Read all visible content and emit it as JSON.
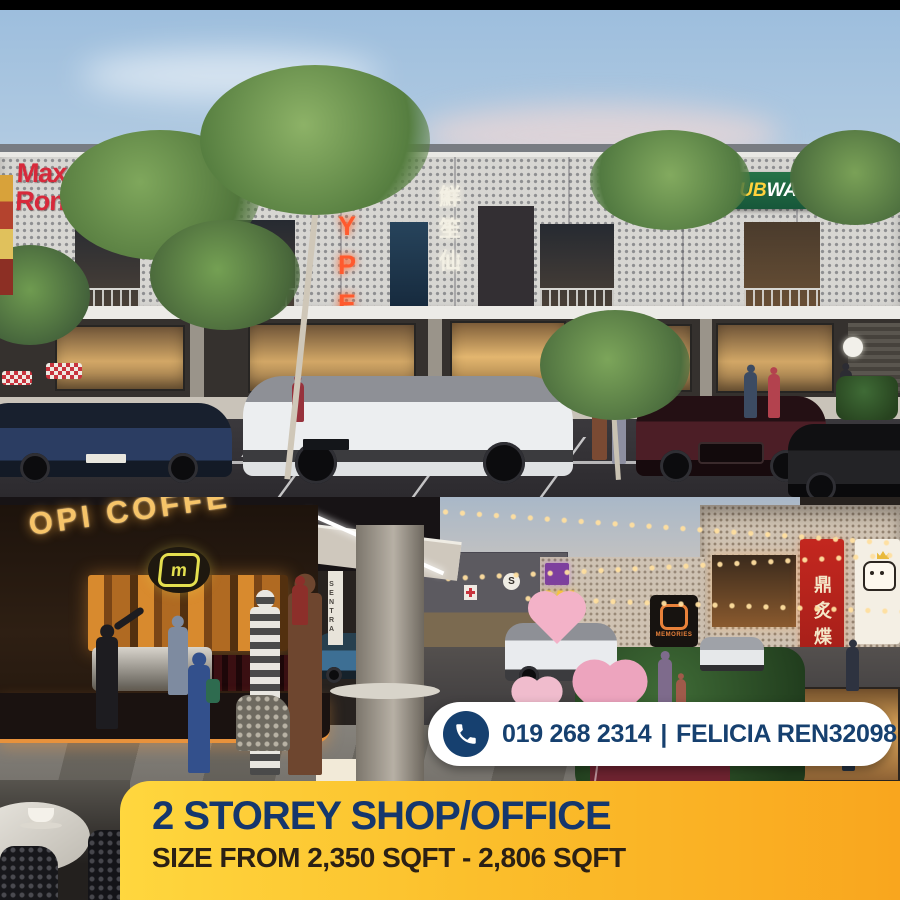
{
  "contact": {
    "phone_number": "019 268 2314",
    "divider": "|",
    "agent": "FELICIA REN32098"
  },
  "banner": {
    "title": "2 STOREY SHOP/OFFICE",
    "subtitle": "SIZE FROM 2,350 SQFT - 2,806 SQFT"
  },
  "colors": {
    "navy": "#16406f",
    "banner_yellow": "#ffd73e",
    "banner_orange": "#f9a61e",
    "dubway_green": "#1f6a41",
    "neon_red": "#ff5a2e",
    "brand_red": "#d7293b",
    "pill_bg": "#ffffff"
  },
  "top_scene": {
    "signs": {
      "max_ronalds": "Max Ronald's",
      "hype": "HYPE",
      "chinese_neon": "鮮笙仙",
      "dubway_dub": "DUB",
      "dubway_way": "WAY"
    }
  },
  "bottom_scene": {
    "signs": {
      "coffee": "OPI COFFE",
      "m_logo": "m",
      "w_sign": "W",
      "memories": "MEMORIES",
      "red_chinese": "鼎炙煠",
      "pole_banner": "SENTRA",
      "s_circle": "S"
    }
  }
}
